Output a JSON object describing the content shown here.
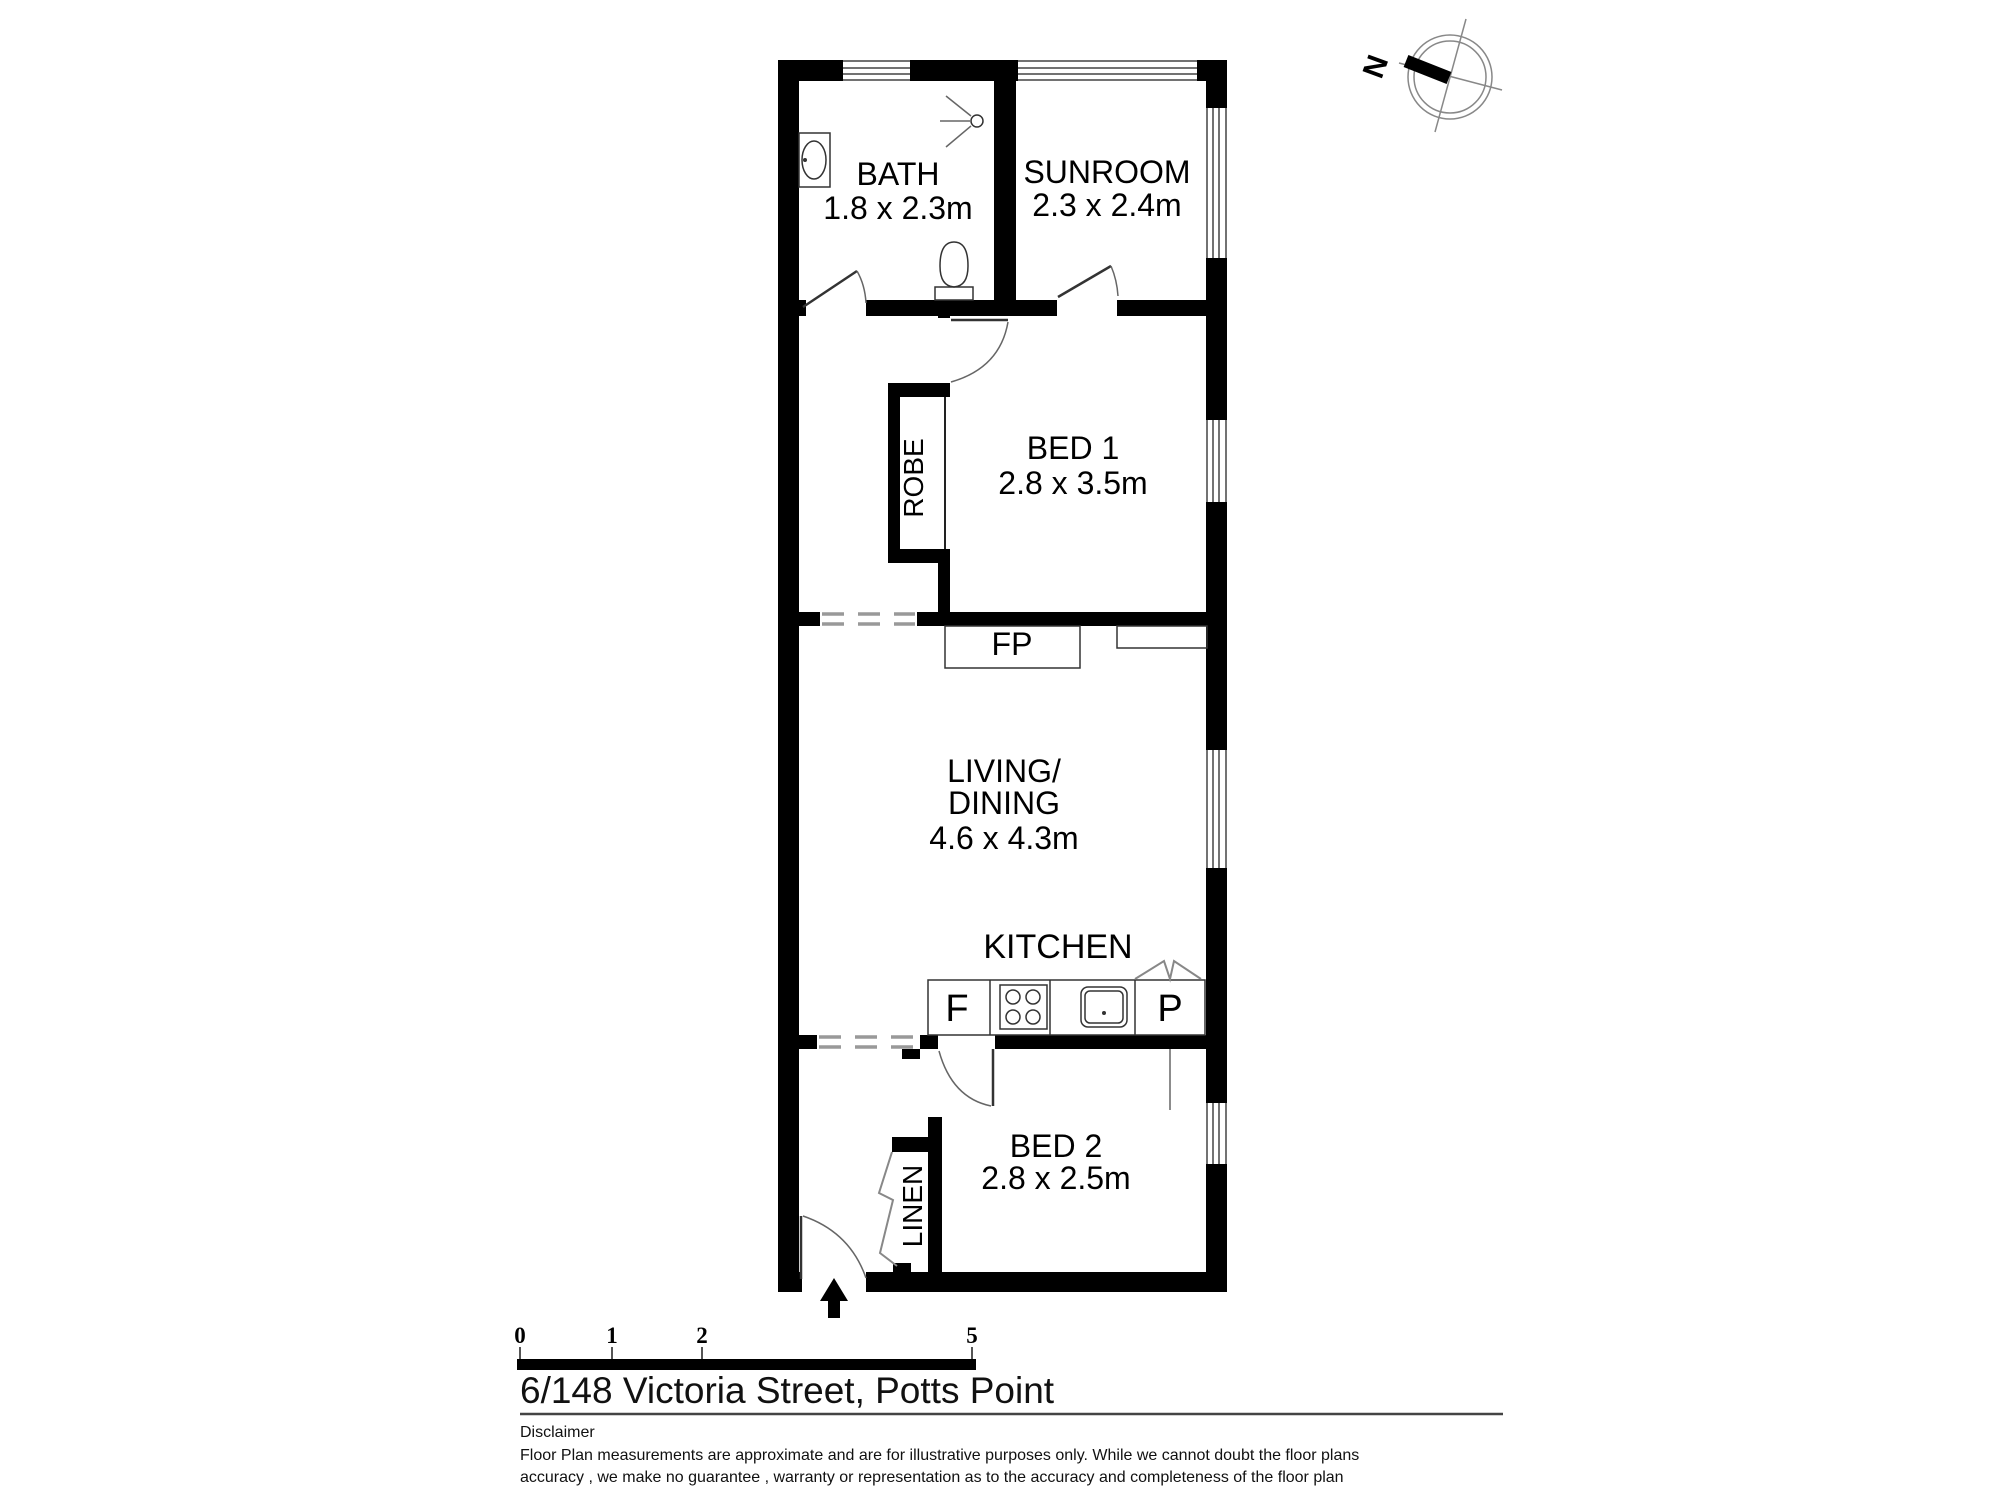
{
  "title": "6/148 Victoria Street, Potts Point",
  "compass": {
    "north_label": "N"
  },
  "rooms": {
    "bath": {
      "name": "BATH",
      "dims": "1.8 x 2.3m"
    },
    "sunroom": {
      "name": "SUNROOM",
      "dims": "2.3 x 2.4m"
    },
    "bed1": {
      "name": "BED 1",
      "dims": "2.8 x 3.5m"
    },
    "living": {
      "name_line1": "LIVING/",
      "name_line2": "DINING",
      "dims": "4.6 x 4.3m"
    },
    "kitchen": {
      "name": "KITCHEN"
    },
    "bed2": {
      "name": "BED 2",
      "dims": "2.8 x 2.5m"
    }
  },
  "closets": {
    "robe": {
      "name": "ROBE"
    },
    "linen": {
      "name": "LINEN"
    }
  },
  "fixtures": {
    "fireplace": "FP",
    "fridge": "F",
    "pantry": "P"
  },
  "scale_bar": {
    "ticks": [
      "0",
      "1",
      "2",
      "5"
    ]
  },
  "disclaimer": {
    "heading": "Disclaimer",
    "line1": "Floor Plan measurements are approximate and are for illustrative purposes only. While we cannot doubt the floor plans",
    "line2": "accuracy , we make no guarantee , warranty or representation as to the accuracy and completeness of the floor plan"
  },
  "colors": {
    "wall": "#000000",
    "background": "#ffffff",
    "dashed_opening": "#999999"
  }
}
